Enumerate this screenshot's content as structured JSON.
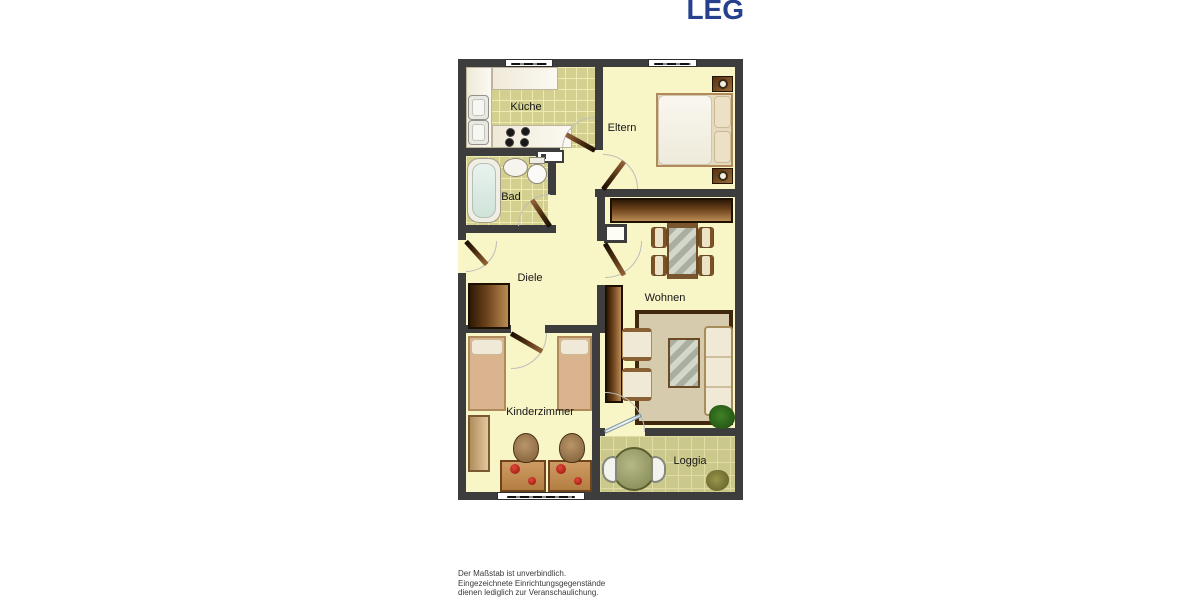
{
  "logo": {
    "text": "LEG",
    "color": "#26408e"
  },
  "rooms": {
    "kueche": "Küche",
    "eltern": "Eltern",
    "bad": "Bad",
    "diele": "Diele",
    "wohnen": "Wohnen",
    "kinderzimmer": "Kinderzimmer",
    "loggia": "Loggia"
  },
  "disclaimer": {
    "line1": "Der Maßstab ist unverbindlich.",
    "line2": "Eingezeichnete Einrichtungsgegenstände",
    "line3": "dienen lediglich zur Veranschaulichung."
  },
  "colors": {
    "wall": "#3d3d3d",
    "floor_cream": "#f8f5c6",
    "tile_olive": "#d3d08f",
    "tile_loggia": "#cbc88c",
    "furniture_brown": "#6e431c",
    "logo_blue": "#26408e"
  }
}
